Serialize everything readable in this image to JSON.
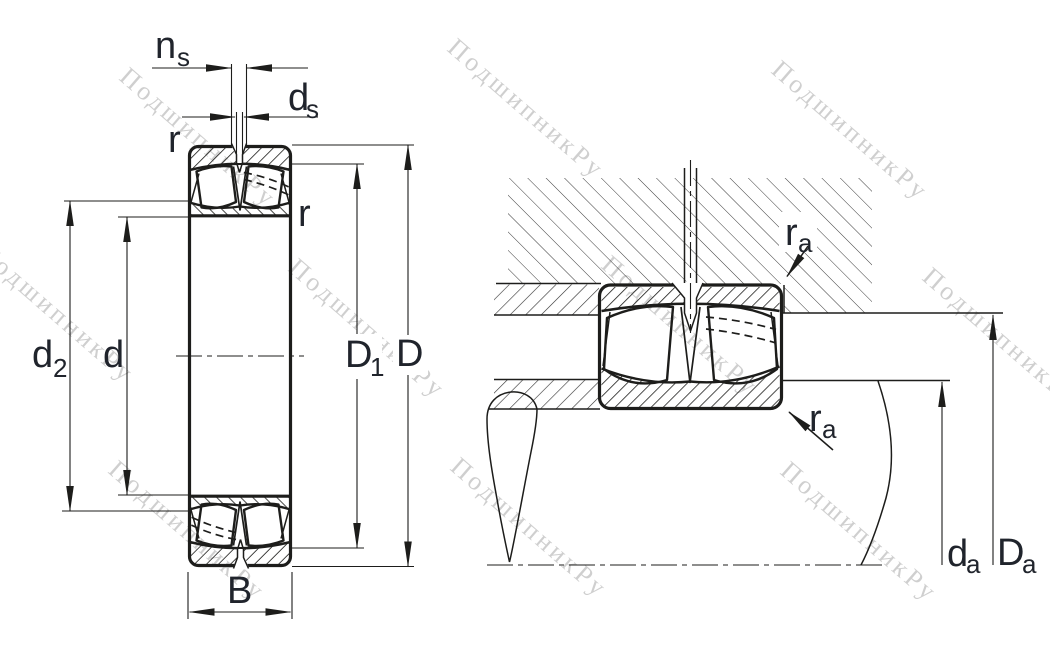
{
  "drawing": {
    "type": "bearing-technical-drawing",
    "left_view": "spherical roller bearing cross-section",
    "right_view": "mounted bearing abutment cross-section"
  },
  "dims": {
    "ns": {
      "main": "n",
      "sub": "s"
    },
    "ds": {
      "main": "d",
      "sub": "s"
    },
    "r": "r",
    "d2": {
      "main": "d",
      "sub": "2"
    },
    "d": "d",
    "D1": {
      "main": "D",
      "sub": "1"
    },
    "D": "D",
    "B": "B",
    "ra": {
      "main": "r",
      "sub": "a"
    },
    "da": {
      "main": "d",
      "sub": "a"
    },
    "Da": {
      "main": "D",
      "sub": "a"
    }
  },
  "watermark": {
    "text": "ПодшипникРу"
  },
  "colors": {
    "line": "#1d1d1b",
    "label": "#20242c",
    "watermark": "#a9a9a9"
  }
}
